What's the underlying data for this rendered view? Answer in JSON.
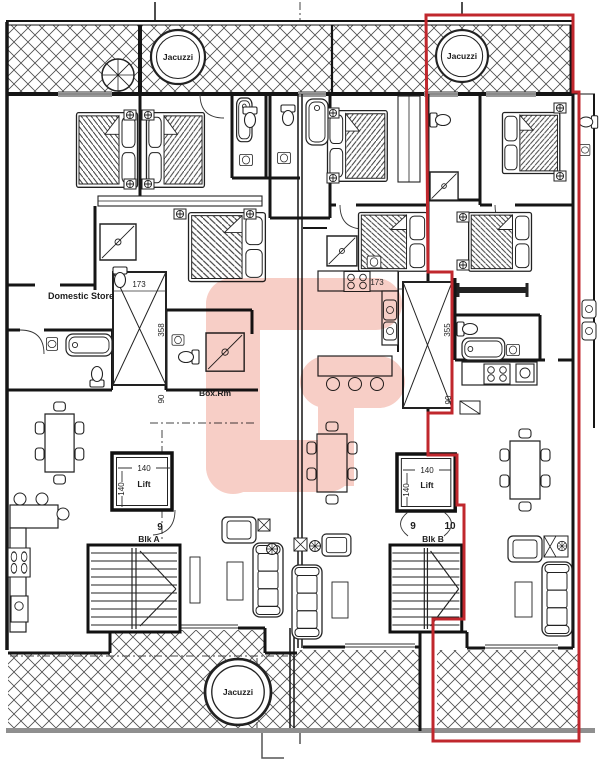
{
  "plan": {
    "labels": {
      "jacuzzi_top_left": "Jacuzzi",
      "jacuzzi_top_right": "Jacuzzi",
      "jacuzzi_bottom": "Jacuzzi",
      "domestic_store": "Domestic Store",
      "box_room": "Box.Rm",
      "lift_block_a": "Lift",
      "lift_block_b": "Lift",
      "block_a": "Blk A",
      "block_b": "Blk B",
      "door_number_block_a": "9",
      "door_number_block_b_left": "9",
      "door_number_block_b_right": "10"
    },
    "dimensions": {
      "shaft_a_width": "173",
      "shaft_a_length": "358",
      "shaft_a_corridor": "90",
      "shaft_b_width": "173",
      "shaft_b_length": "355",
      "shaft_b_corridor": "90",
      "lift_a_width": "140",
      "lift_a_depth": "140",
      "lift_b_width": "140",
      "lift_b_depth": "140"
    },
    "colors": {
      "highlight_boundary": "#c0272d",
      "watermark": "#f5c2b8",
      "plan_line": "#1c1c1c",
      "terrace_base": "#8f8f8f"
    }
  }
}
